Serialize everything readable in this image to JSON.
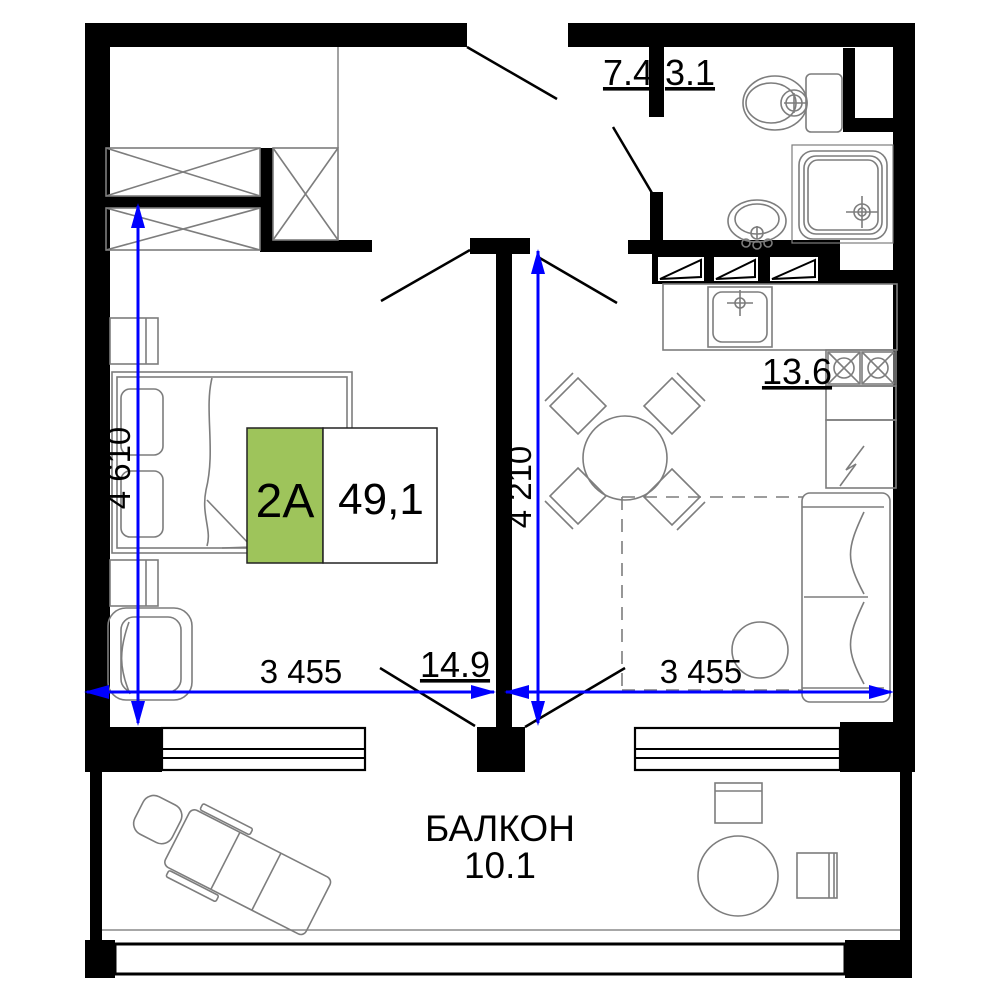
{
  "badge": {
    "unit": "2A",
    "total_area": "49,1"
  },
  "rooms": {
    "hall": {
      "area": "7.4"
    },
    "bathroom": {
      "area": "3.1"
    },
    "kitchen": {
      "area": "13.6"
    },
    "living": {
      "area": "14.9"
    },
    "balcony": {
      "name": "БАЛКОН",
      "area": "10.1"
    }
  },
  "dimensions": {
    "bedroom_depth": "4 610",
    "living_depth": "4 210",
    "bedroom_width": "3 455",
    "living_width": "3 455"
  },
  "colors": {
    "wall": "#000000",
    "dimension": "#0000ff",
    "badge_green": "#9ec45b",
    "furniture": "#7d7d7d"
  },
  "furniture_icons": [
    "wardrobe",
    "bed",
    "nightstand",
    "armchair",
    "dining-table",
    "dining-chair",
    "sofa",
    "coffee-table",
    "kitchen-counter",
    "kitchen-sink",
    "stove",
    "fridge",
    "toilet",
    "bathroom-sink",
    "shower",
    "lounge-chair",
    "balcony-table",
    "balcony-chair",
    "window"
  ]
}
